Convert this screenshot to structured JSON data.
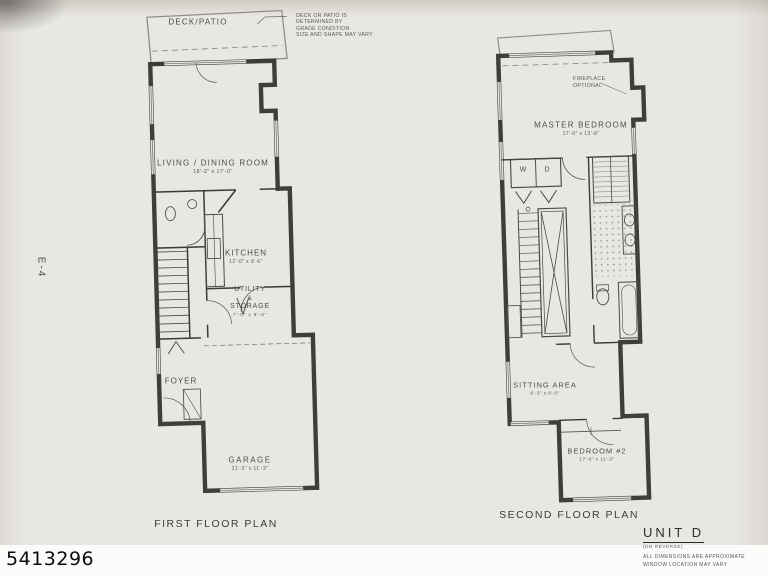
{
  "palette": {
    "paper": "#e9e7e1",
    "ink": "#2b2b2b",
    "label_ink": "#4c4c4c",
    "photo_id_ink": "#0a0a0a"
  },
  "margins": {
    "sheet_code": "E-4",
    "photo_id": "5413296"
  },
  "first_floor": {
    "caption": "FIRST FLOOR PLAN",
    "deck": {
      "label": "DECK/PATIO",
      "note_lines": [
        "DECK OR PATIO IS",
        "DETERMINED BY",
        "GRADE CONDITION",
        "SIZE AND SHAPE MAY VARY"
      ]
    },
    "rooms": {
      "living": {
        "name": "LIVING / DINING ROOM",
        "dims": "18'-3\" x 17'-0\""
      },
      "kitchen": {
        "name": "KITCHEN",
        "dims": "12'-0\" x 9'-6\""
      },
      "utility": {
        "line1": "UTILITY",
        "line2": "&",
        "line3": "STORAGE",
        "dims": "7'-0\" x 8'-6\""
      },
      "foyer": {
        "name": "FOYER"
      },
      "garage": {
        "name": "GARAGE",
        "dims": "21'-3\" x 11'-3\""
      }
    }
  },
  "second_floor": {
    "caption": "SECOND FLOOR PLAN",
    "fireplace_note": {
      "line1": "FIREPLACE",
      "line2": "OPTIONAL"
    },
    "rooms": {
      "master": {
        "name": "MASTER BEDROOM",
        "dims": "17'-0\" x 13'-8\""
      },
      "laundry": {
        "washer": "W",
        "dryer": "D"
      },
      "sitting": {
        "name": "SITTING AREA",
        "dims": "8'-3\" x 9'-0\""
      },
      "bedroom2": {
        "name": "BEDROOM #2",
        "dims": "17'-6\" x 11'-3\""
      }
    }
  },
  "title_block": {
    "unit": "UNIT D",
    "unit_sub": "(DD REVERSE)",
    "notes": [
      "ALL DIMENSIONS ARE APPROXIMATE",
      "WINDOW LOCATION MAY VARY"
    ]
  }
}
